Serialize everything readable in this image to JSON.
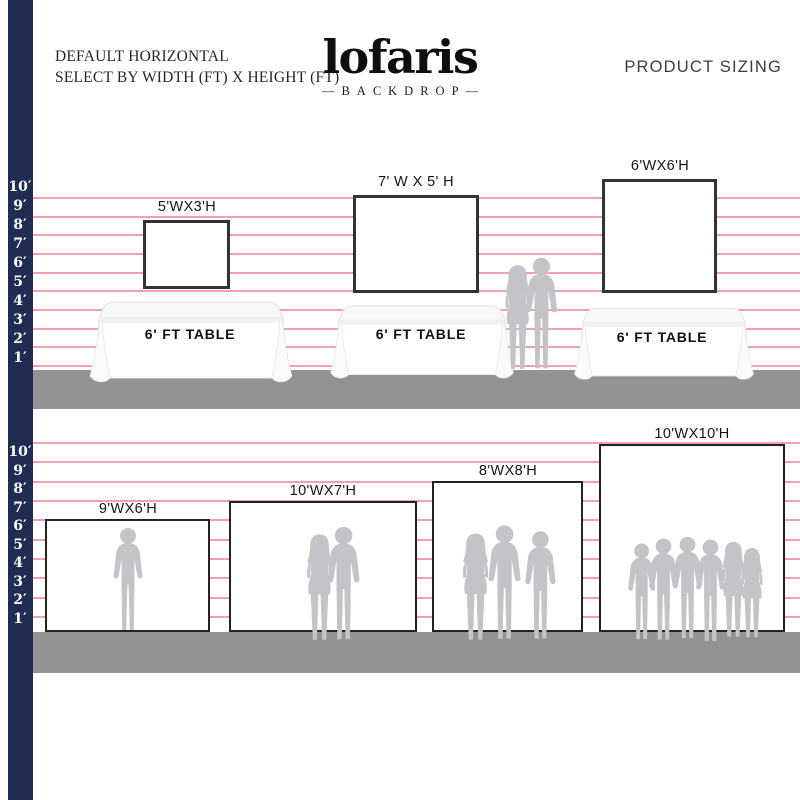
{
  "header": {
    "left_line1": "DEFAULT HORIZONTAL",
    "left_line2": "SELECT BY WIDTH (FT) X HEIGHT (FT)",
    "logo_text": "lofaris",
    "logo_sub": "—BACKDROP—",
    "right_title": "PRODUCT SIZING"
  },
  "ruler": {
    "labels": [
      "10′",
      "9′",
      "8′",
      "7′",
      "6′",
      "5′",
      "4′",
      "3′",
      "2′",
      "1′"
    ]
  },
  "tabletop_section": {
    "items": [
      {
        "size_label": "5'WX3'H",
        "width_ft": 5,
        "height_ft": 3,
        "table_label": "6' FT TABLE"
      },
      {
        "size_label": "7' W X 5' H",
        "width_ft": 7,
        "height_ft": 5,
        "table_label": "6' FT TABLE"
      },
      {
        "size_label": "6'WX6'H",
        "width_ft": 6,
        "height_ft": 6,
        "table_label": "6' FT TABLE"
      }
    ]
  },
  "floor_section": {
    "items": [
      {
        "size_label": "9'WX6'H",
        "width_ft": 9,
        "height_ft": 6,
        "people_count": 1
      },
      {
        "size_label": "10'WX7'H",
        "width_ft": 10,
        "height_ft": 7,
        "people_count": 2
      },
      {
        "size_label": "8'WX8'H",
        "width_ft": 8,
        "height_ft": 8,
        "people_count": 3
      },
      {
        "size_label": "10'WX10'H",
        "width_ft": 10,
        "height_ft": 10,
        "people_count": 6
      }
    ]
  },
  "colors": {
    "navy_bar": "#202c52",
    "grid_line": "#efa0b2",
    "floor": "#939393",
    "silhouette": "#c4c4c8"
  }
}
